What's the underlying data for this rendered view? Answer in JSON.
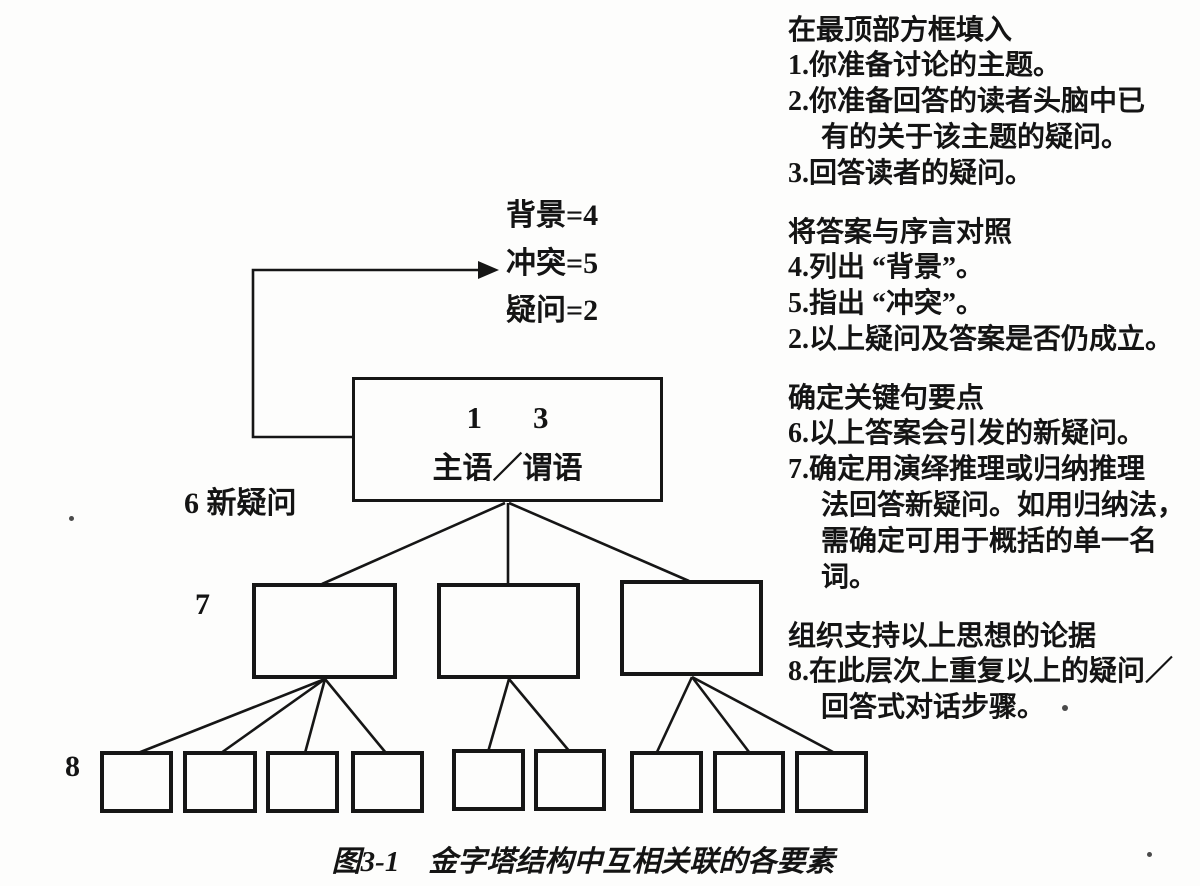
{
  "diagram": {
    "intro_labels": {
      "background": "背景=4",
      "conflict": "冲突=5",
      "question": "疑问=2"
    },
    "top_box": {
      "numbers": "1　3",
      "text": "主语／谓语"
    },
    "side_labels": {
      "new_question": "6 新疑问",
      "keyline_level": "7",
      "support_level": "8"
    },
    "caption": "图3-1　金字塔结构中互相关联的各要素"
  },
  "notes": [
    {
      "title": "在最顶部方框填入",
      "lines": [
        "1.你准备讨论的主题。",
        "2.你准备回答的读者头脑中已",
        "有的关于该主题的疑问。",
        "3.回答读者的疑问。"
      ]
    },
    {
      "title": "将答案与序言对照",
      "lines": [
        "4.列出 “背景”。",
        "5.指出 “冲突”。",
        "2.以上疑问及答案是否仍成立。"
      ]
    },
    {
      "title": "确定关键句要点",
      "lines": [
        "6.以上答案会引发的新疑问。",
        "7.确定用演绎推理或归纳推理",
        "法回答新疑问。如用归纳法，",
        "需确定可用于概括的单一名",
        "词。"
      ]
    },
    {
      "title": "组织支持以上思想的论据",
      "lines": [
        "8.在此层次上重复以上的疑问／",
        "回答式对话步骤。"
      ]
    }
  ]
}
